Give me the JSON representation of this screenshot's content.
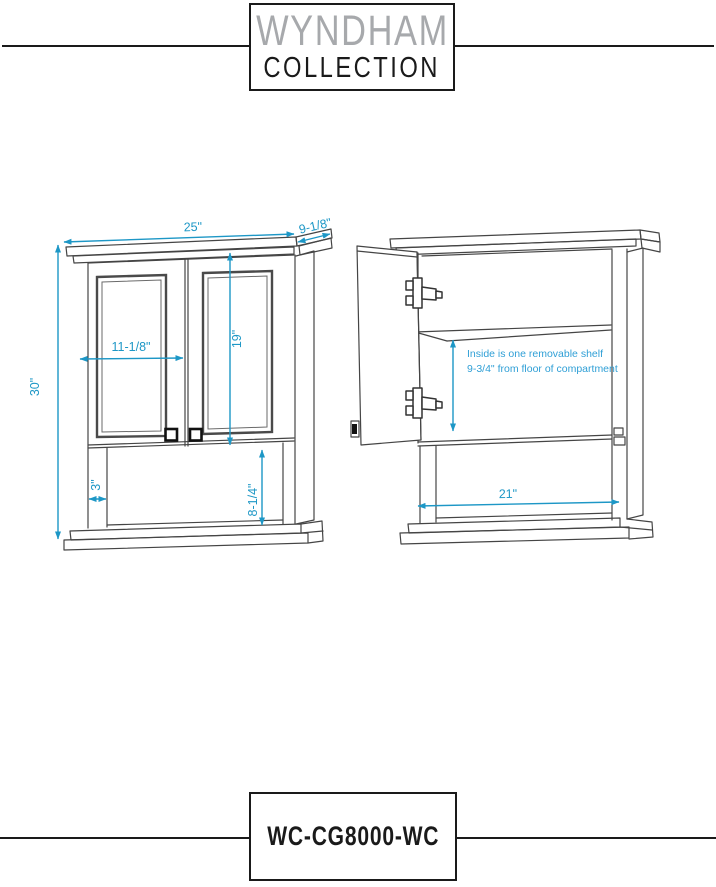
{
  "brand": {
    "line1": "WYNDHAM",
    "line2": "COLLECTION"
  },
  "footer": {
    "model": "WC-CG8000-WC"
  },
  "drawing": {
    "front": {
      "width": "25\"",
      "depth": "9-1/8\"",
      "height": "30\"",
      "panel_width": "11-1/8\"",
      "panel_height": "19\"",
      "leg": "3\"",
      "open_height": "8-1/4\""
    },
    "side": {
      "note1": "Inside is one removable shelf",
      "note2": "9-3/4\" from floor of compartment",
      "shelf_span": "21\""
    },
    "colors": {
      "dimension": "#1d97c6",
      "note": "#2f9fd6",
      "line": "#454545",
      "logo_gray": "#a7a9ac",
      "ink": "#1a1a1a"
    }
  }
}
